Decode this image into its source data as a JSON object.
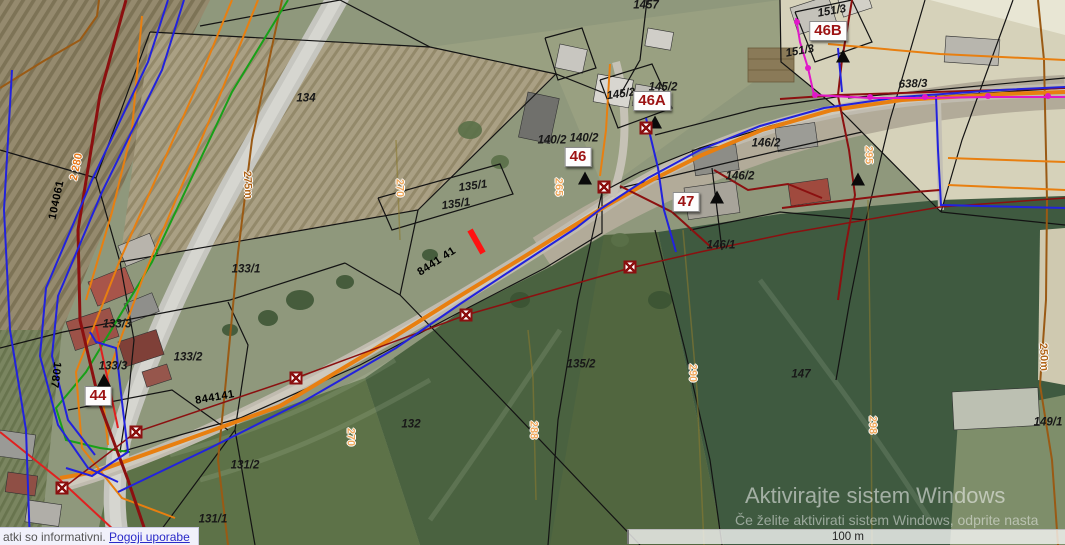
{
  "footer": {
    "disclaimer": "atki so informativni.",
    "terms_link": "Pogoji uporabe"
  },
  "scalebar": {
    "label": "100 m"
  },
  "watermark": {
    "line1": "Aktivirajte sistem Windows",
    "line2": "Če želite aktivirati sistem Windows, odprite nasta"
  },
  "map": {
    "house_numbers": [
      {
        "text": "44",
        "x": 98,
        "y": 396
      },
      {
        "text": "46",
        "x": 578,
        "y": 157
      },
      {
        "text": "46A",
        "x": 652,
        "y": 101
      },
      {
        "text": "46B",
        "x": 828,
        "y": 31
      },
      {
        "text": "47",
        "x": 686,
        "y": 202
      }
    ],
    "labels": [
      {
        "text": "1457",
        "x": 646,
        "y": 6,
        "rot": 0,
        "type": "parcel"
      },
      {
        "text": "134",
        "x": 306,
        "y": 99,
        "rot": 0,
        "type": "parcel"
      },
      {
        "text": "135/1",
        "x": 473,
        "y": 187,
        "rot": -8,
        "type": "parcel"
      },
      {
        "text": "135/1",
        "x": 456,
        "y": 205,
        "rot": -8,
        "type": "parcel"
      },
      {
        "text": "133/1",
        "x": 246,
        "y": 270,
        "rot": 0,
        "type": "parcel"
      },
      {
        "text": "133/3",
        "x": 117,
        "y": 325,
        "rot": 0,
        "type": "parcel"
      },
      {
        "text": "133/3",
        "x": 113,
        "y": 367,
        "rot": 0,
        "type": "parcel"
      },
      {
        "text": "133/2",
        "x": 188,
        "y": 358,
        "rot": 0,
        "type": "parcel"
      },
      {
        "text": "131/2",
        "x": 245,
        "y": 466,
        "rot": 0,
        "type": "parcel"
      },
      {
        "text": "131/1",
        "x": 213,
        "y": 520,
        "rot": 0,
        "type": "parcel"
      },
      {
        "text": "132",
        "x": 411,
        "y": 425,
        "rot": 0,
        "type": "parcel"
      },
      {
        "text": "135/2",
        "x": 581,
        "y": 365,
        "rot": 0,
        "type": "parcel"
      },
      {
        "text": "140/2",
        "x": 552,
        "y": 141,
        "rot": 0,
        "type": "parcel"
      },
      {
        "text": "140/2",
        "x": 584,
        "y": 139,
        "rot": 0,
        "type": "parcel"
      },
      {
        "text": "145/2",
        "x": 621,
        "y": 95,
        "rot": -8,
        "type": "parcel"
      },
      {
        "text": "145/2",
        "x": 663,
        "y": 88,
        "rot": 0,
        "type": "parcel"
      },
      {
        "text": "146/2",
        "x": 766,
        "y": 144,
        "rot": 0,
        "type": "parcel"
      },
      {
        "text": "146/2",
        "x": 740,
        "y": 177,
        "rot": 0,
        "type": "parcel"
      },
      {
        "text": "146/1",
        "x": 721,
        "y": 246,
        "rot": 0,
        "type": "parcel"
      },
      {
        "text": "147",
        "x": 801,
        "y": 375,
        "rot": 0,
        "type": "parcel"
      },
      {
        "text": "151/3",
        "x": 832,
        "y": 12,
        "rot": -10,
        "type": "parcel"
      },
      {
        "text": "151/3",
        "x": 800,
        "y": 52,
        "rot": -10,
        "type": "parcel"
      },
      {
        "text": "638/3",
        "x": 913,
        "y": 85,
        "rot": -2,
        "type": "parcel"
      },
      {
        "text": "149/1",
        "x": 1048,
        "y": 423,
        "rot": 0,
        "type": "parcel"
      },
      {
        "text": "104061",
        "x": 57,
        "y": 200,
        "rot": -78,
        "type": "road"
      },
      {
        "text": "8441 41",
        "x": 437,
        "y": 262,
        "rot": -33,
        "type": "road"
      },
      {
        "text": "844141",
        "x": 215,
        "y": 398,
        "rot": -10,
        "type": "road"
      },
      {
        "text": "1087",
        "x": 55,
        "y": 375,
        "rot": 97,
        "type": "road"
      },
      {
        "text": "2 280",
        "x": 77,
        "y": 167,
        "rot": -78,
        "type": "route"
      },
      {
        "text": "270",
        "x": 399,
        "y": 188,
        "rot": 90,
        "type": "elev"
      },
      {
        "text": "265",
        "x": 558,
        "y": 187,
        "rot": 90,
        "type": "elev"
      },
      {
        "text": "270",
        "x": 350,
        "y": 437,
        "rot": 90,
        "type": "elev"
      },
      {
        "text": "288",
        "x": 533,
        "y": 430,
        "rot": 90,
        "type": "elev"
      },
      {
        "text": "290",
        "x": 692,
        "y": 373,
        "rot": 90,
        "type": "elev"
      },
      {
        "text": "298",
        "x": 872,
        "y": 425,
        "rot": 90,
        "type": "elev"
      },
      {
        "text": "295",
        "x": 868,
        "y": 155,
        "rot": 90,
        "type": "elev"
      },
      {
        "text": "275m",
        "x": 247,
        "y": 185,
        "rot": 87,
        "type": "contour"
      },
      {
        "text": "250m",
        "x": 1043,
        "y": 357,
        "rot": 87,
        "type": "contour"
      }
    ],
    "markers": {
      "triangles": [
        [
          104,
          380
        ],
        [
          585,
          178
        ],
        [
          655,
          122
        ],
        [
          843,
          56
        ],
        [
          717,
          197
        ],
        [
          858,
          179
        ]
      ],
      "squares": [
        [
          646,
          128
        ],
        [
          630,
          267
        ],
        [
          466,
          315
        ],
        [
          296,
          378
        ],
        [
          136,
          432
        ],
        [
          62,
          488
        ],
        [
          604,
          187
        ]
      ],
      "magenta_dots": [
        [
          797,
          22
        ],
        [
          808,
          68
        ],
        [
          815,
          95
        ],
        [
          870,
          97
        ],
        [
          925,
          97
        ],
        [
          988,
          96
        ],
        [
          1048,
          96
        ]
      ]
    },
    "colors": {
      "parcel_boundary": "#131313",
      "house_number_text": "#9c1313",
      "elevation_label": "#efa85c",
      "contour_line": "#9a5a14",
      "utility_blue": "#2222dd",
      "utility_orange": "#e87f10",
      "utility_dark_red": "#8b1010",
      "utility_green": "#18a018",
      "utility_magenta": "#e018c8",
      "highlight_red_tick": "#ff1212"
    }
  }
}
